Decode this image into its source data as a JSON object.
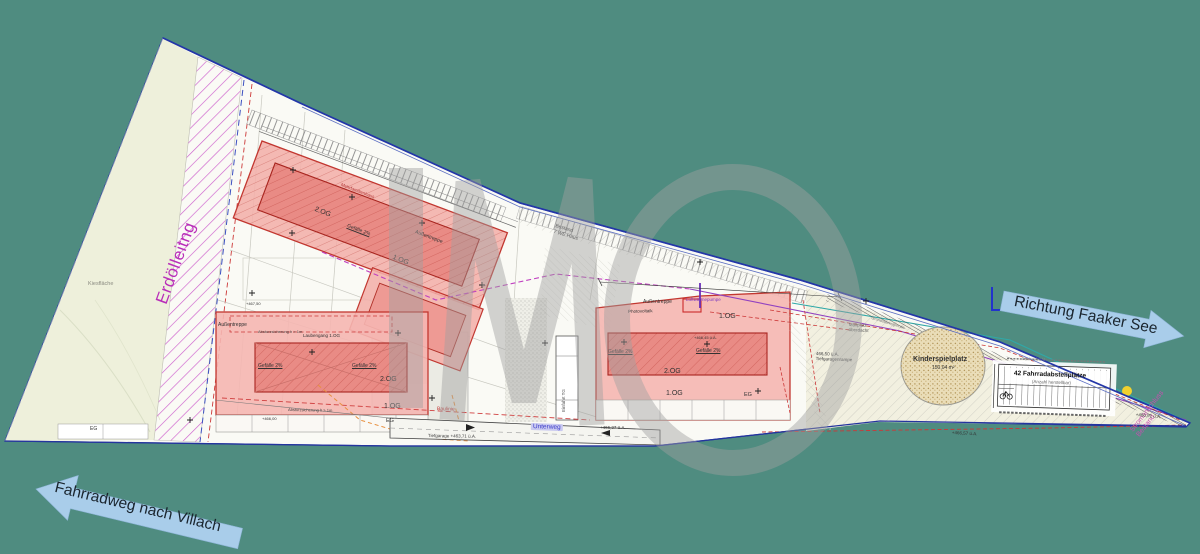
{
  "background_color": "#4F8C80",
  "watermark": {
    "text": "IMO"
  },
  "arrows": {
    "right": {
      "label": "Richtung Faaker See",
      "color": "#A9CDEA"
    },
    "left": {
      "label": "Fahrradweg nach Villach",
      "color": "#A9CDEA"
    }
  },
  "site": {
    "erdoelleitung": "Erdölleitng",
    "kiesflaeche": "Kiesfläche",
    "stromanschluss_line1": "Stromanschluss",
    "stromanschluss_line2": "Bestand",
    "strasse": "Unterweg",
    "baulinie": "Baulinie",
    "tiefgarage": "Tiefgarage  +463,71 ü.A.",
    "einfahrt_tg": "Einfahrt TG",
    "bestand_line1": "Bestand",
    "bestand_line2": "7 WE Haus",
    "grenze": "Grundstücksgrenze",
    "mehrfamilienhaus": "Mehrfamilienhaus",
    "laubengang": "Laubengang 1.OG",
    "absturz": "Absturzsicherung h > 1m",
    "muellplatz_line1": "Müllplatz",
    "muellplatz_line2": "überdacht",
    "rampe_line1": "466,50 ü.A.",
    "rampe_line2": "Tiefgaragenrampe",
    "luftwaermepumpe": "Luftwärmepumpe",
    "photovoltaik": "Photovoltaik",
    "dachaufsicht": "Dachaufsicht",
    "eg_left": "EG",
    "elev_1": "+466,27 ü.A.",
    "elev_2": "+466,57 ü.A.",
    "elev_3": "+466,91 ü.A.",
    "elev_4": "+467,50",
    "elev_5": "+466,00",
    "elev_6": "+466,45 ü.A."
  },
  "buildings": {
    "a": {
      "og2": "2.OG",
      "og1": "1.OG",
      "treppe": "Außentreppe",
      "gefaelle": "Gefälle 2%"
    },
    "b": {
      "og2": "2.OG",
      "og1": "1.OG",
      "eg": "EG",
      "treppe": "Außentreppe",
      "gefaelle": "Gefälle 2%"
    },
    "c": {
      "og1_top": "1.OG",
      "og2": "2.OG",
      "og1": "1.OG",
      "eg": "EG",
      "treppe": "Außentreppe",
      "gefaelle": "Gefälle 2%"
    }
  },
  "kinderspielplatz": {
    "label": "Kinderspielplatz",
    "area": "150,04 m²"
  },
  "fahrrad": {
    "title": "42 Fahrradabstellplätze",
    "subtitle": "(Anzahl herstellbar)"
  }
}
